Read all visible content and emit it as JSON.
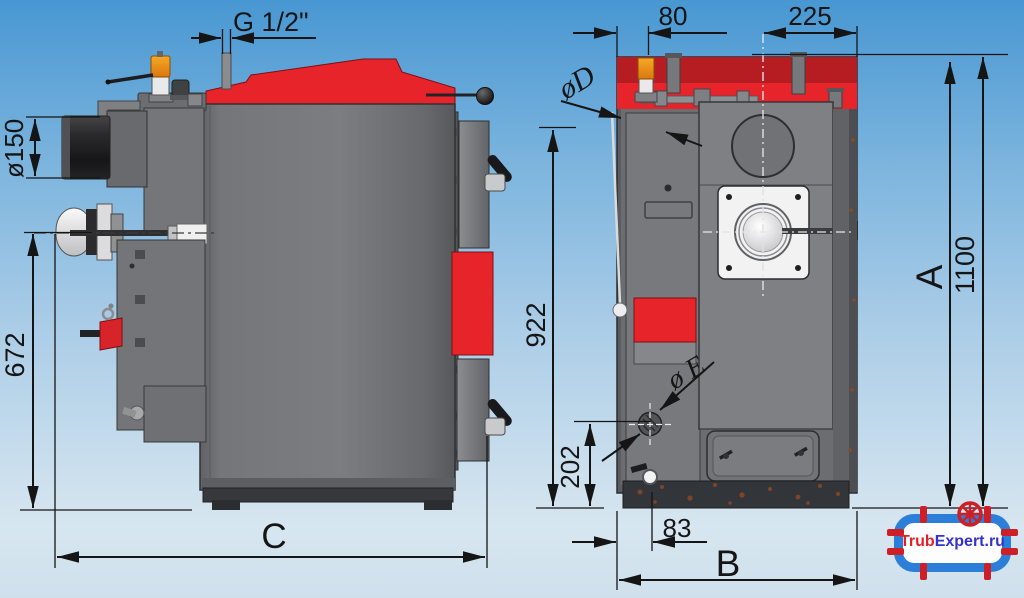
{
  "drawing_title": "Solid fuel boiler dimensional drawing (side view and rear view)",
  "labels": {
    "g_thread": "G 1/2\"",
    "flue_diameter": "ø150",
    "height_672": "672",
    "depth_c": "C",
    "offset_80": "80",
    "offset_225": "225",
    "dia_d": "øD",
    "height_922": "922",
    "height_202": "202",
    "dia_e": "ø E",
    "offset_83": "83",
    "width_b": "B",
    "height_a": "A",
    "height_1100": "1100"
  },
  "logo": {
    "part_red": "Trub",
    "part_blue": "Expert.ru"
  },
  "colors": {
    "accent_red": "#e8242b",
    "dark_red": "#b51d23",
    "body_gray": "#6f7174",
    "line_color": "#151515",
    "bg_top": "#4897d2",
    "bg_bottom": "#d7e6f0",
    "logo_blue": "#2b7fd9",
    "logo_red": "#cf1f26"
  }
}
